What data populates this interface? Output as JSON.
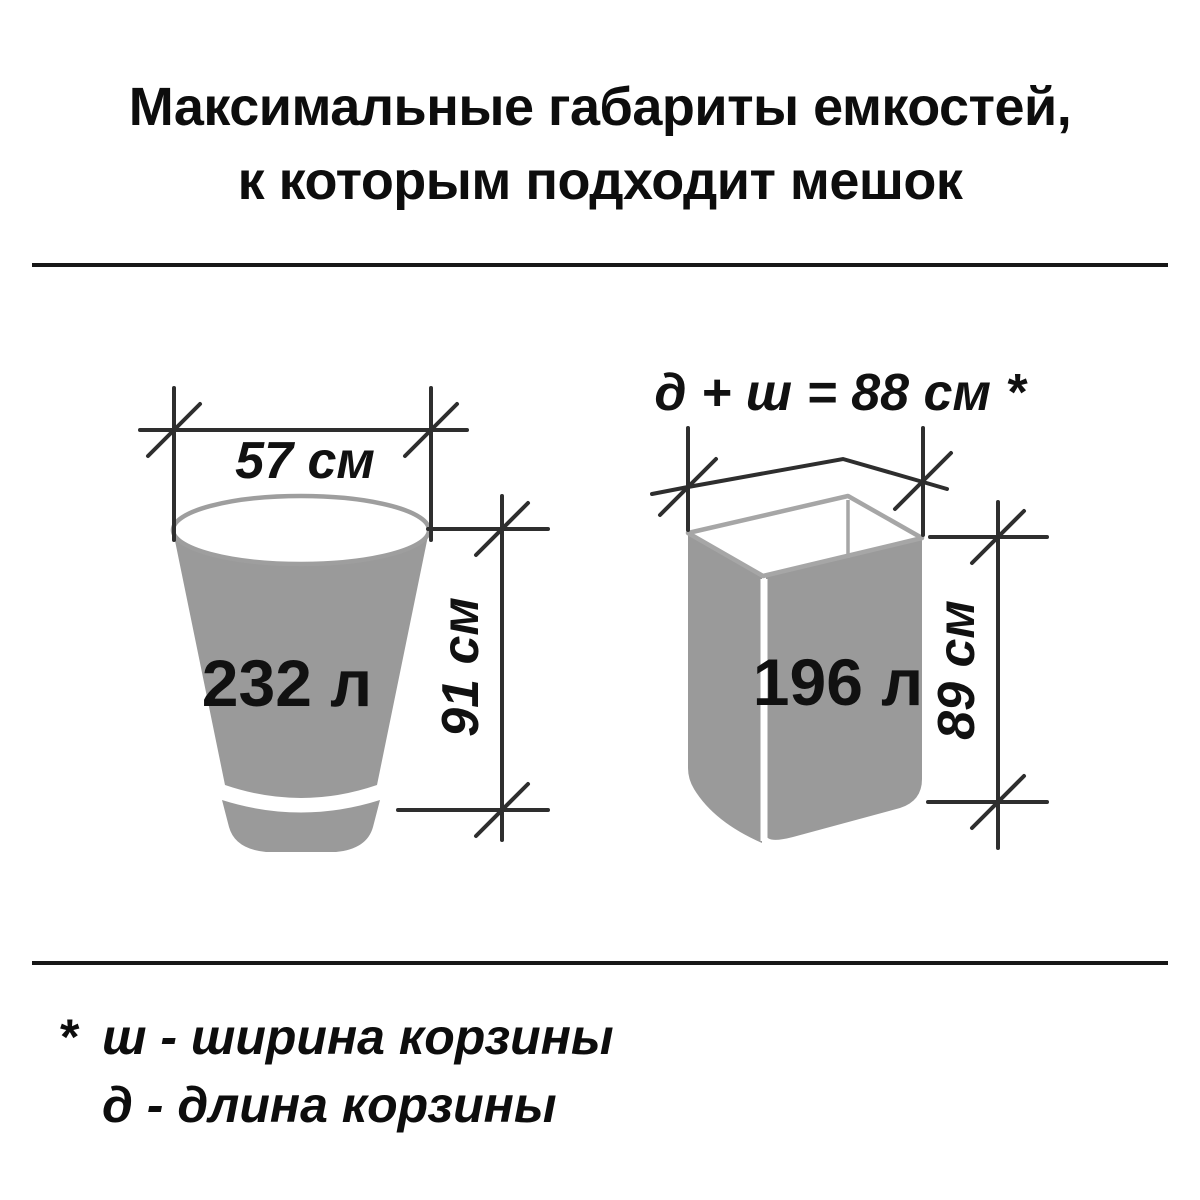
{
  "title": {
    "line1": "Максимальные габариты емкостей,",
    "line2": "к которым подходит мешок"
  },
  "figures": {
    "bucket": {
      "volume": "232 л",
      "width": "57 см",
      "height": "91 см"
    },
    "box": {
      "volume": "196 л",
      "top_formula": "д + ш = 88 см *",
      "height": "89 см"
    }
  },
  "footnote": {
    "marker": "*",
    "line1": "ш - ширина корзины",
    "line2": "д  - длина корзины"
  },
  "colors": {
    "container_gray": "#9a9a9a",
    "rim_gray": "#a6a6a6",
    "dimension_line": "#2e2e2e",
    "text_black": "#111111",
    "background": "#ffffff"
  }
}
